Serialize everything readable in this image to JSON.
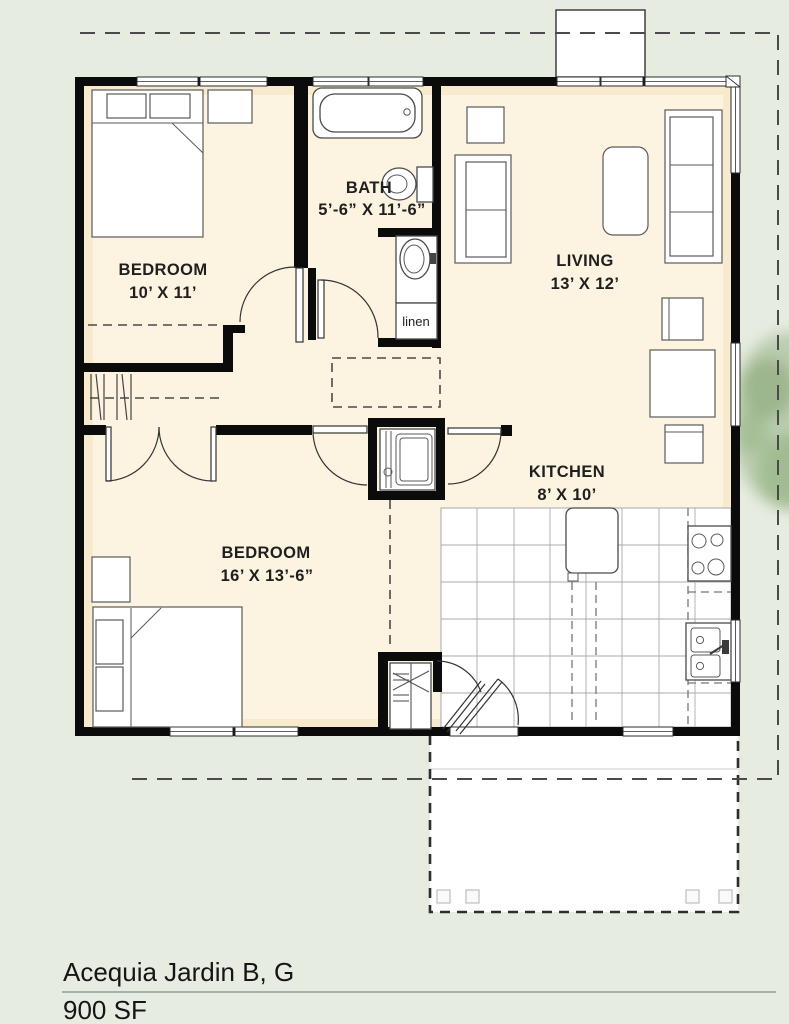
{
  "title": {
    "project": "Acequia Jardin B, G",
    "area": "900 SF"
  },
  "rooms": {
    "bedroom1": {
      "name": "BEDROOM",
      "dims": "10’ X 11’"
    },
    "bedroom2": {
      "name": "BEDROOM",
      "dims": "16’ X 13’-6”"
    },
    "bath": {
      "name": "BATH",
      "dims": "5’-6” X 11’-6”"
    },
    "living": {
      "name": "LIVING",
      "dims": "13’ X 12’"
    },
    "kitchen": {
      "name": "KITCHEN",
      "dims": "8’ X 10’"
    },
    "linen_label": "linen"
  },
  "colors": {
    "background": "#e7ece1",
    "floor_cream": "#fcf4e0",
    "wall_black": "#0b0b0b",
    "tile_white": "#ffffff",
    "property_line": "#4a4a4a",
    "tree_green": "#86a873",
    "title_rule": "#8fa08f"
  }
}
